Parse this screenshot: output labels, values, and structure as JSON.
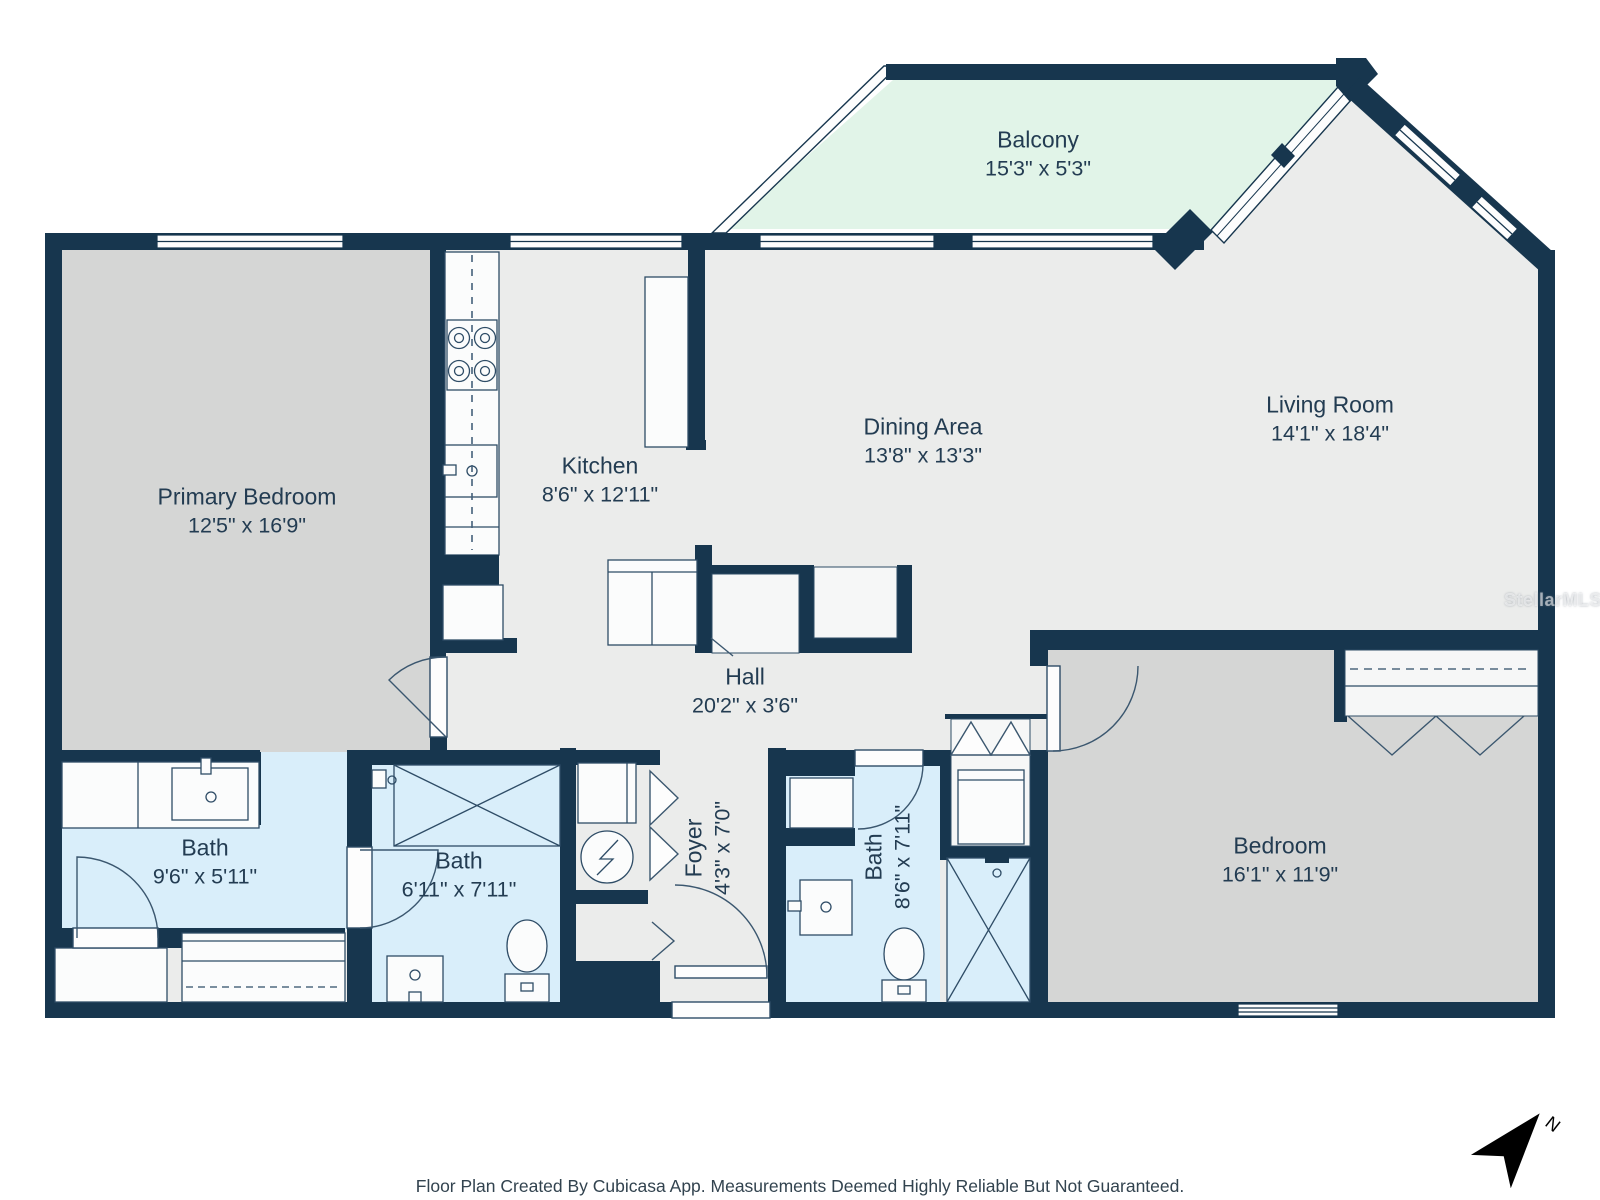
{
  "rooms": [
    {
      "name": "Balcony",
      "dims": "15'3\" x 5'3\""
    },
    {
      "name": "Primary Bedroom",
      "dims": "12'5\" x 16'9\""
    },
    {
      "name": "Kitchen",
      "dims": "8'6\" x 12'11\""
    },
    {
      "name": "Dining Area",
      "dims": "13'8\" x 13'3\""
    },
    {
      "name": "Living Room",
      "dims": "14'1\" x 18'4\""
    },
    {
      "name": "Hall",
      "dims": "20'2\" x 3'6\""
    },
    {
      "name": "Bath",
      "dims": "9'6\" x 5'11\""
    },
    {
      "name": "Bath",
      "dims": "6'11\" x 7'11\""
    },
    {
      "name": "Foyer",
      "dims": "4'3\" x 7'0\""
    },
    {
      "name": "Bath",
      "dims": "8'6\" x 7'11\""
    },
    {
      "name": "Bedroom",
      "dims": "16'1\" x 11'9\""
    }
  ],
  "footer": {
    "disclaimer": "Floor Plan Created By Cubicasa App. Measurements Deemed Highly Reliable But Not Guaranteed."
  },
  "watermark": "StellarMLS",
  "compass": {
    "label": "N"
  },
  "colors": {
    "wall": "#17364e",
    "floor": "#ebeceb",
    "bedroom_floor": "#d5d6d5",
    "bath_floor": "#d9eefa",
    "balcony_floor": "#e1f4e8",
    "fixture_white": "#fbfcfc",
    "label_text": "#233c52"
  },
  "fixture_icons": [
    "stove-icon",
    "sink-icon",
    "refrigerator-icon",
    "shower-icon",
    "toilet-icon",
    "water-heater-icon",
    "closet-bifold-icon",
    "window-icon",
    "door-arc-icon",
    "north-arrow-icon"
  ]
}
